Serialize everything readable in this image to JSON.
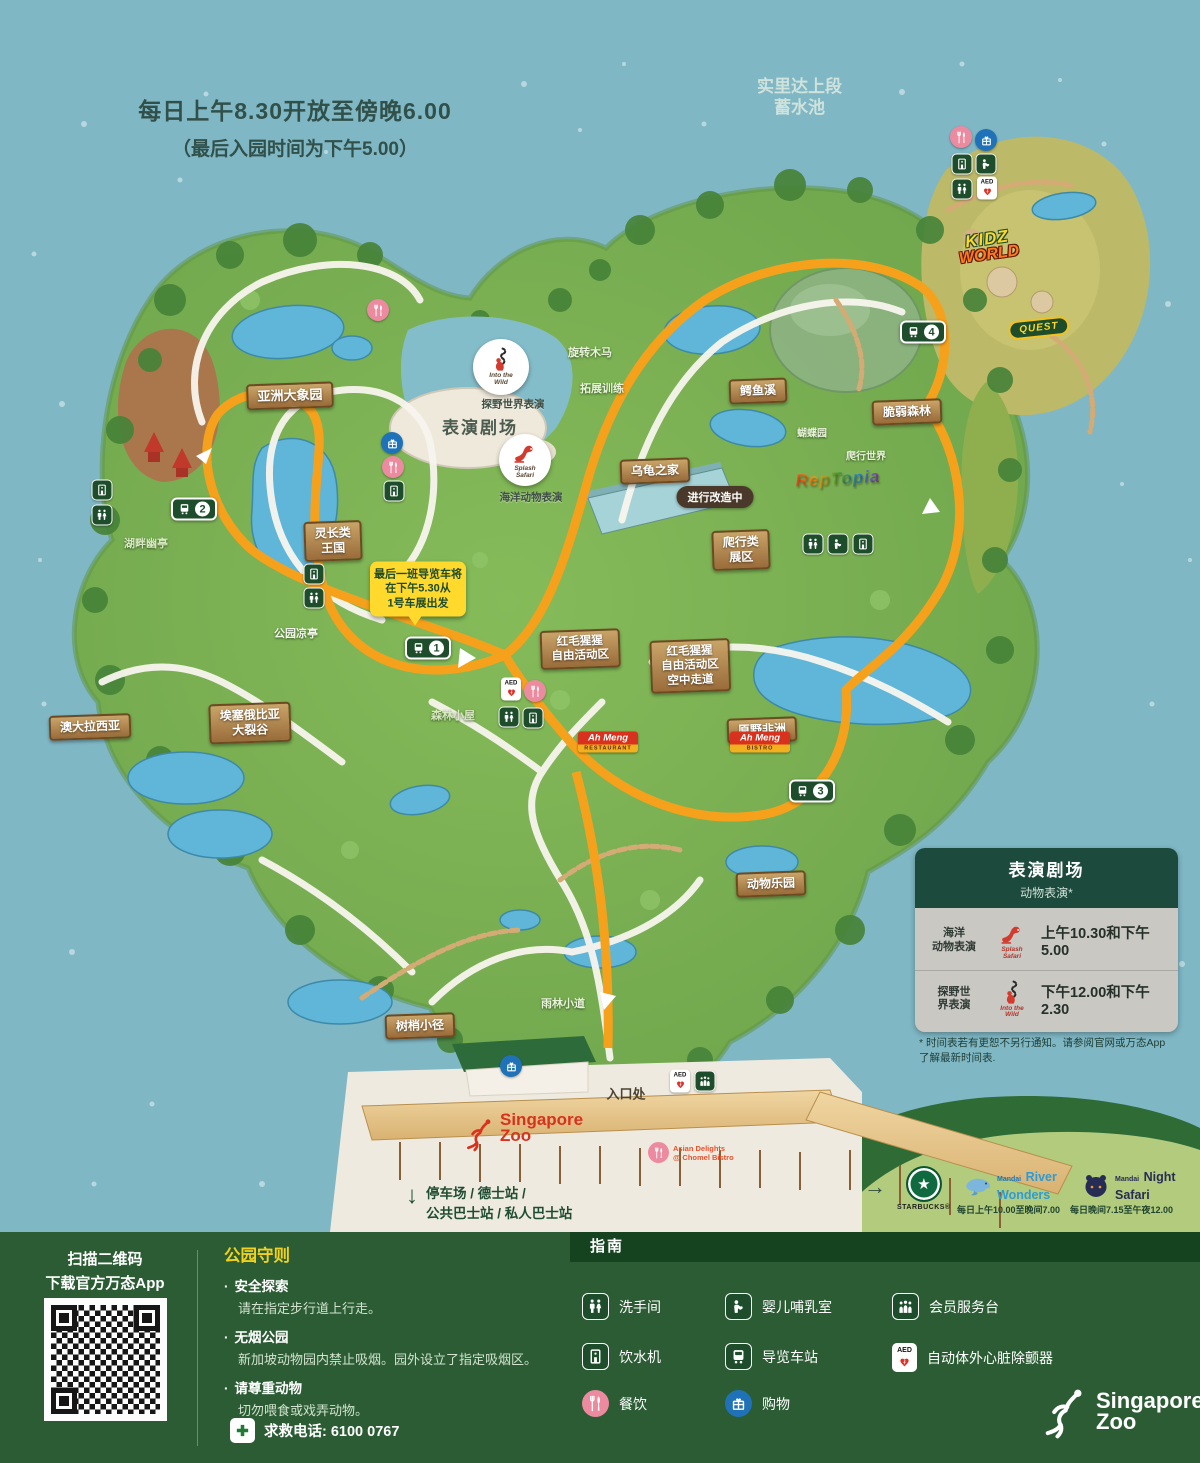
{
  "header": {
    "hours1": "每日上午8.30开放至傍晚6.00",
    "hours2": "（最后入园时间为下午5.00）",
    "reservoir": "实里达上段\n蓄水池"
  },
  "signs": {
    "asian_elephants": "亚洲大象园",
    "primate_kingdom": "灵长类\n王国",
    "australasia": "澳大拉西亚",
    "rift_valley": "埃塞俄比亚\n大裂谷",
    "turtle_house": "乌龟之家",
    "croc_creek": "鳄鱼溪",
    "fragile_forest": "脆弱森林",
    "reptile_zone": "爬行类\n展区",
    "orangutan_free_range": "红毛猩猩\n自由活动区",
    "orangutan_boardwalk": "红毛猩猩\n自由活动区\n空中走道",
    "wild_africa": "原野非洲",
    "animal_land": "动物乐园",
    "treetop_trail": "树梢小径"
  },
  "labels": {
    "carousel": "旋转木马",
    "ropes_course": "拓展训练",
    "butterfly_garden": "蝴蝶园",
    "reptile_world": "爬行世界",
    "lakeside_pavilion": "湖畔幽亭",
    "park_pavilion": "公园凉亭",
    "forest_lodge": "森林小屋",
    "rainforest_walk": "雨林小道",
    "entrance": "入口处",
    "under_renovation": "进行改造中"
  },
  "theatre": {
    "stage": "表演剧场",
    "into_wild_label": "探野世界表演",
    "splash_label": "海洋动物表演",
    "into_wild_badge": "Into the\nWild",
    "splash_badge": "Splash\nSafari"
  },
  "tram": {
    "note": "最后一班导览车将\n在下午5.30从\n1号车展出发",
    "stops": [
      "1",
      "2",
      "3",
      "4"
    ]
  },
  "entrance_area": {
    "zoo_logo": "Singapore\nZoo",
    "asian_delights": "Asian Delights\n@ Chomel Bistro",
    "parking_arrow": "↓",
    "parking": "停车场 / 德士站 /\n公共巴士站 / 私人巴士站",
    "ah_meng_restaurant": {
      "name": "Ah Meng",
      "type": "Restaurant"
    },
    "ah_meng_bistro": {
      "name": "Ah Meng",
      "type": "Bistro"
    }
  },
  "partners": {
    "arrow": "→",
    "starbucks_star": "★",
    "starbucks": "STARBUCKS®",
    "river_brand": "Mandai",
    "river_name": "River\nWonders",
    "river_hours": "每日上午10.00至晚间7.00",
    "night_brand": "Mandai",
    "night_name": "Night\nSafari",
    "night_hours": "每日晚间7.15至午夜12.00"
  },
  "attraction_logos": {
    "kidz_line1": "KIDZ",
    "kidz_line2": "WORLD",
    "quest": "QUEST",
    "reptopia": "RepTopia"
  },
  "showtimes": {
    "title": "表演剧场",
    "subtitle": "动物表演*",
    "rows": [
      {
        "label": "海洋\n动物表演",
        "badge": "Splash\nSafari",
        "time": "上午10.30和下午5.00"
      },
      {
        "label": "探野世\n界表演",
        "badge": "Into the\nWild",
        "time": "下午12.00和下午2.30"
      }
    ],
    "footnote": "* 时间表若有更恕不另行通知。请参阅官网或万态App\n了解最新时间表."
  },
  "footer": {
    "qr_line1": "扫描二维码",
    "qr_line2": "下载官方万态App",
    "rules_title": "公园守则",
    "bullet": "·",
    "rules": [
      {
        "title": "安全探索",
        "desc": "请在指定步行道上行走。"
      },
      {
        "title": "无烟公园",
        "desc": "新加坡动物园内禁止吸烟。园外设立了指定吸烟区。"
      },
      {
        "title": "请尊重动物",
        "desc": "切勿喂食或戏弄动物。"
      }
    ],
    "emergency": "求救电话: 6100 0767",
    "guide_title": "指南",
    "legend": [
      {
        "label": "洗手间"
      },
      {
        "label": "婴儿哺乳室"
      },
      {
        "label": "会员服务台"
      },
      {
        "label": "饮水机"
      },
      {
        "label": "导览车站"
      },
      {
        "label": "自动体外心脏除颤器"
      },
      {
        "label": "餐饮"
      },
      {
        "label": "购物"
      }
    ],
    "zoo_logo": "Singapore\nZoo"
  }
}
